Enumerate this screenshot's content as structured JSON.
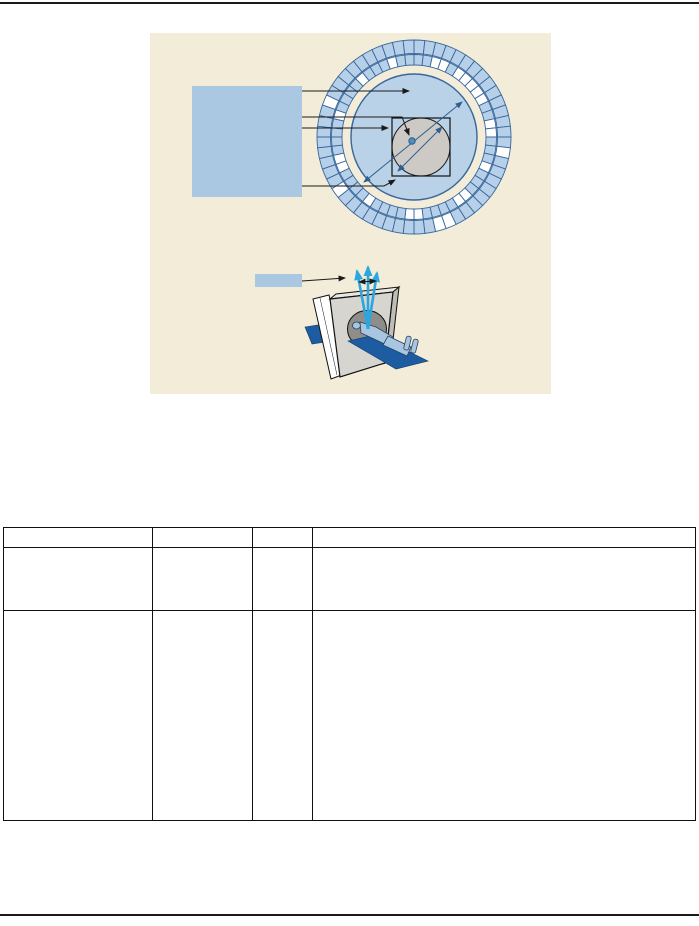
{
  "figure": {
    "colors": {
      "background": "#f2ecd8",
      "callout_box": "#abc8e3",
      "segment": "#b7d0e9",
      "ring_stroke": "#39679b",
      "inner_circle": "#bad2e8",
      "patient_circle": "#cdcac5",
      "isocenter_dot": "#4e8fc0",
      "dimension_line": "#2f5f8e",
      "beam_cyan": "#2aa7df",
      "gantry_front": "#d7d5d0",
      "gantry_top": "#e9e7e2",
      "gantry_side": "#bfbdb8",
      "bore": "#8e8d89",
      "platform_navy": "#1d5ca0",
      "patient_body": "#a9c6e1",
      "line_black": "#1a1a1a"
    },
    "ring": {
      "cx": 264,
      "cy": 104,
      "segments": 56,
      "outer_r0": 83.5,
      "outer_r1": 97,
      "inner_r0": 72,
      "inner_r1": 82.5,
      "outer_white": [
        15,
        24,
        25,
        36,
        45
      ],
      "inner_white": [
        2,
        3,
        5,
        6,
        7,
        8,
        9,
        12,
        13,
        17,
        21,
        22,
        27,
        28,
        33,
        38,
        39,
        44,
        49,
        53
      ]
    },
    "ring_callout_label": "",
    "scanner_callout_label": ""
  },
  "table": {
    "headers": [
      "",
      "",
      "",
      ""
    ],
    "rows": [
      [
        "",
        "",
        "",
        ""
      ],
      [
        "",
        "",
        "",
        ""
      ]
    ]
  }
}
